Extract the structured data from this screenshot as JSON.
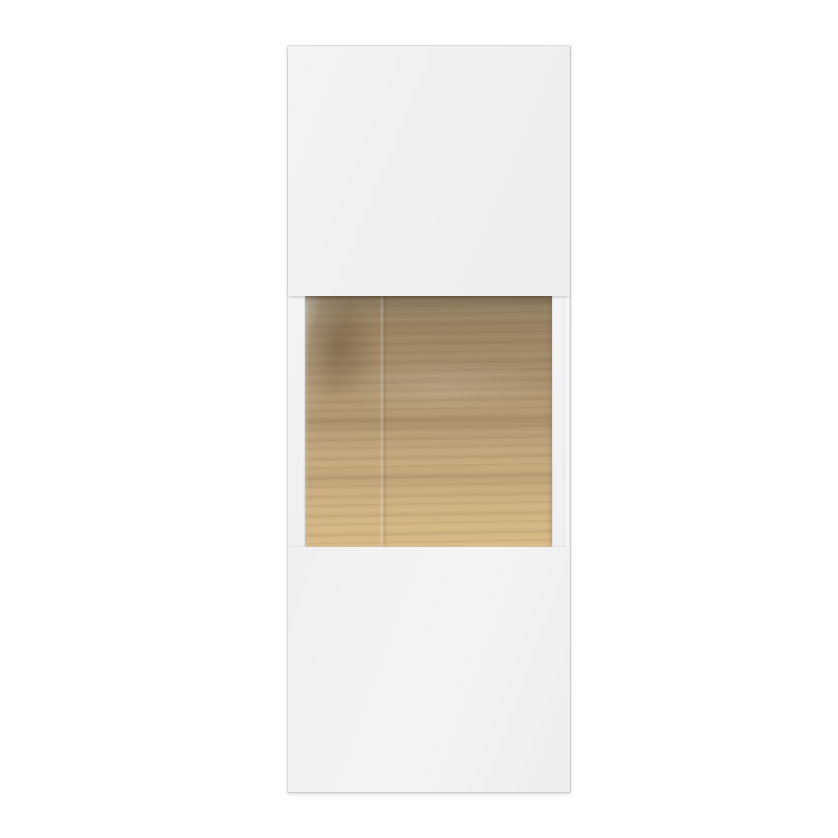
{
  "image_type": "product-photo",
  "subject": "Tall white wall-mounted display cabinet, front view, with a glass middle section revealing an oak wood back panel",
  "visible_text": [],
  "colors": {
    "page-bg": "#ffffff",
    "cabinet-body": "#f0f0f1",
    "cabinet-body-light": "#f4f4f5",
    "cabinet-edge": "#dcdcde",
    "cabinet-edge-dark": "#cfcfd1",
    "wood-top": "#8f7e64",
    "wood-upper": "#a58c69",
    "wood-mid": "#b89e75",
    "wood-lower": "#c8ad7f",
    "wood-bottom": "#d8ba88",
    "wood-knot": "#6f5d46"
  },
  "cabinet": {
    "sections": [
      {
        "name": "top-door-panel",
        "appearance": "plain white panel"
      },
      {
        "name": "glass-section",
        "appearance": "glass window with white side frames, oak back panel visible, dark shadow at top, diagonal reflection upper-left, vertical reflection line about one third across"
      },
      {
        "name": "bottom-door-panel",
        "appearance": "plain white panel"
      }
    ],
    "wood_features": [
      "horizontal oak grain",
      "dark knot upper-left",
      "tone gradient dark grey-brown at top to light tan at bottom",
      "darker wavy grain bands at roughly 16%, 50% and 72% height"
    ]
  }
}
